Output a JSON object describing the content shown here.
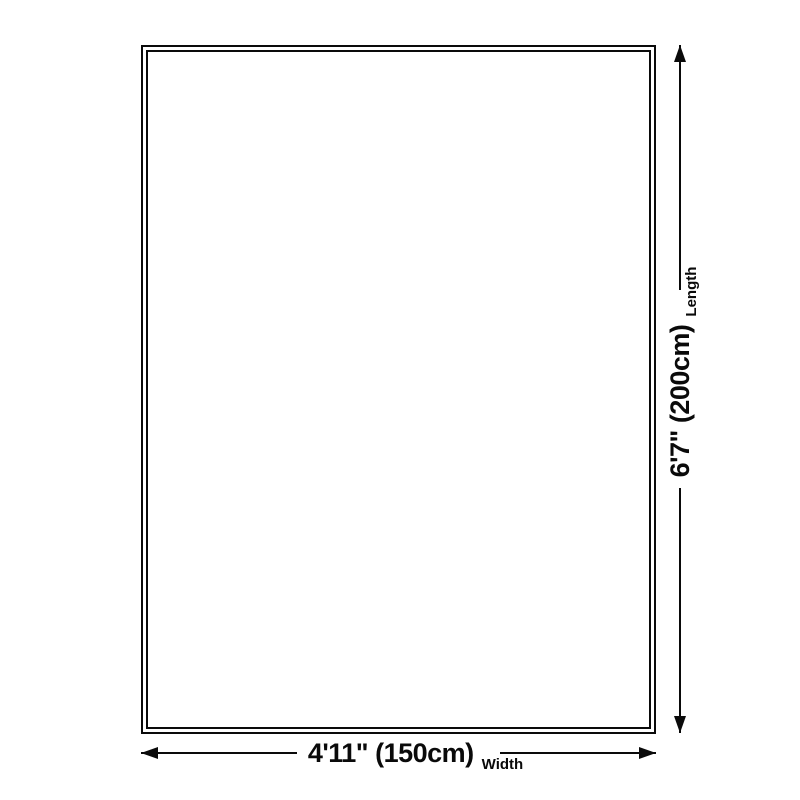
{
  "diagram": {
    "type": "product-size-diagram",
    "shape": "rectangle-double-border",
    "dimensions": {
      "length": {
        "value": "6'7\" (200cm)",
        "label": "Length"
      },
      "width": {
        "value": "4'11\" (150cm)",
        "label": "Width"
      }
    },
    "colors": {
      "line": "#0a0a0a",
      "background": "#ffffff"
    }
  }
}
